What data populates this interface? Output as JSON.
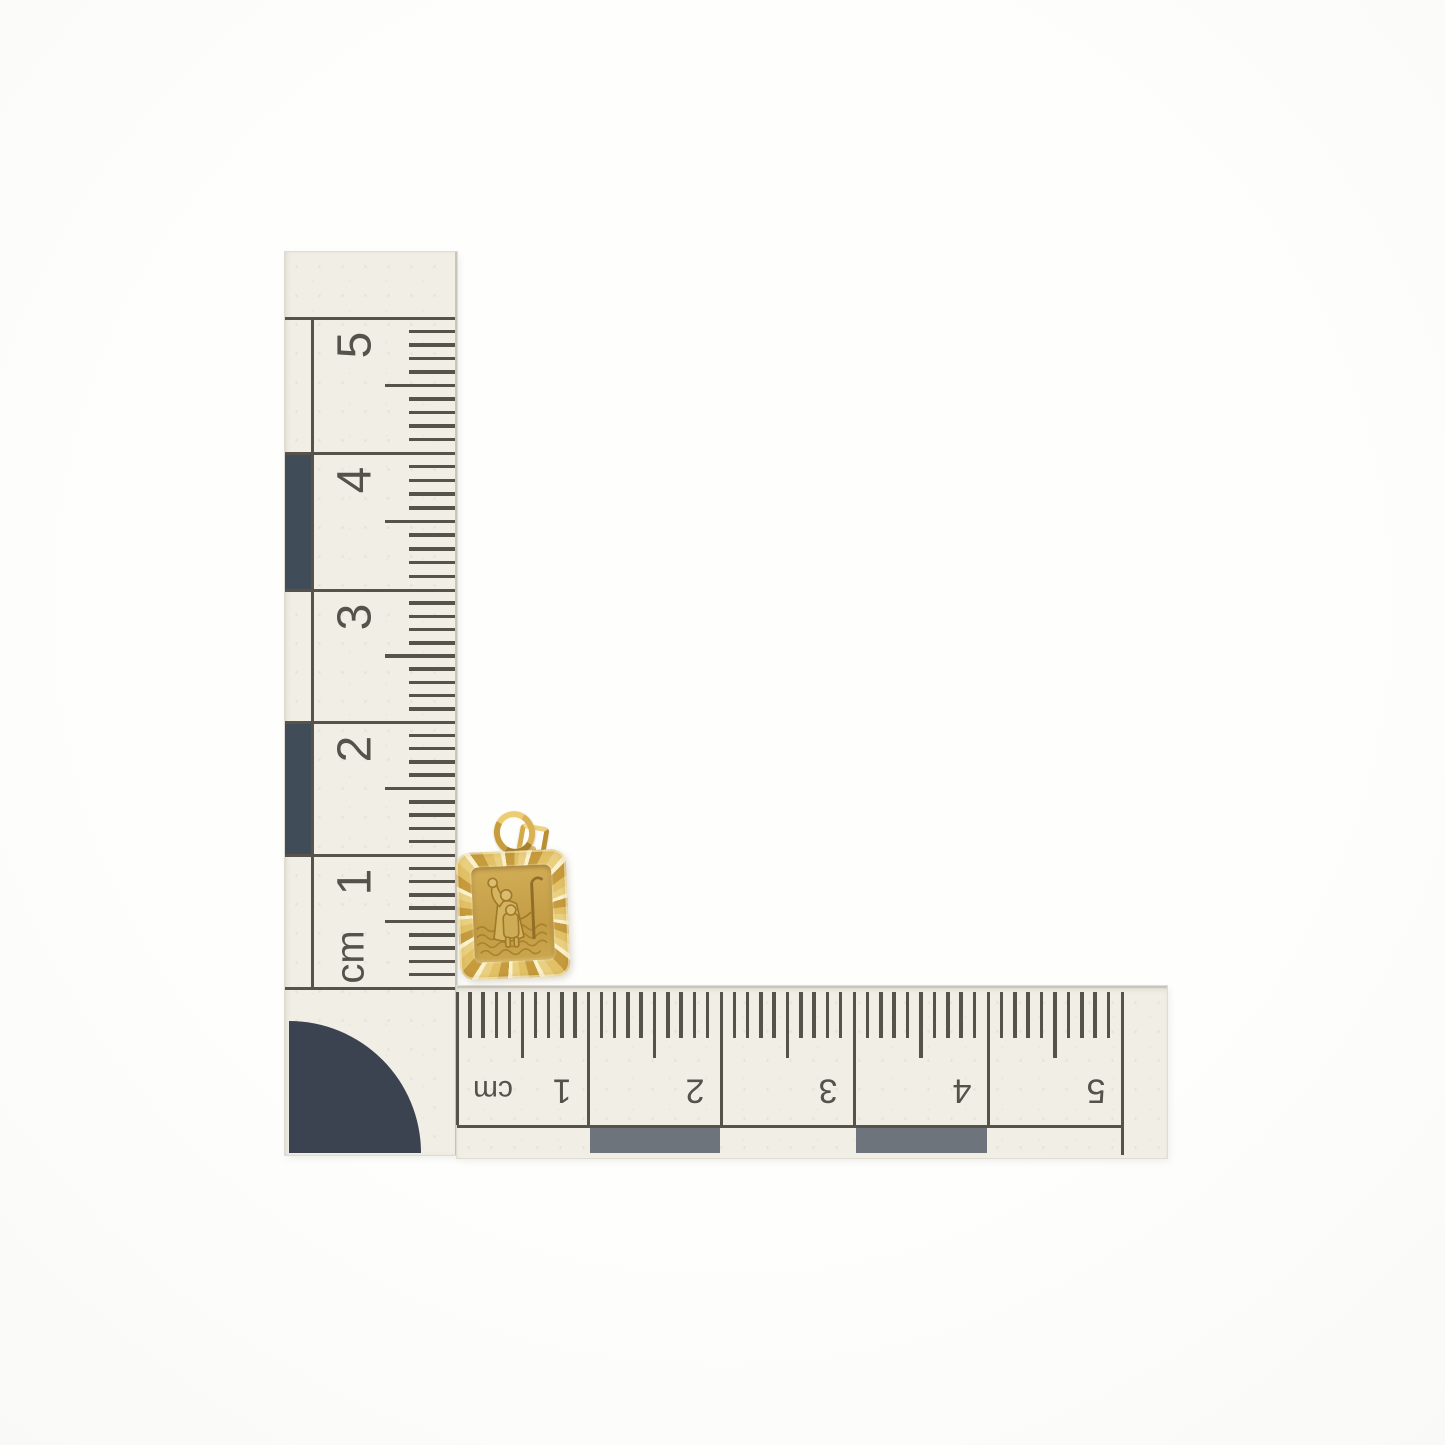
{
  "scene": {
    "background_color": "#fdfdfc",
    "subject": "gold rectangular St Christopher pendant photographed with two centimetre scale rulers"
  },
  "rulers": {
    "paper_color": "#f1eee6",
    "line_color": "#57534b",
    "digit_color": "#55514b",
    "vertical": {
      "unit_label": "cm",
      "labels": [
        "5",
        "4",
        "3",
        "2",
        "1",
        "cm"
      ],
      "dark_segment_color": "#414c59",
      "dark_segments_between_marks": [
        [
          "4",
          "3"
        ],
        [
          "2",
          "1"
        ]
      ],
      "corner_shape": "dark-quarter-circle",
      "corner_color": "#3c4350"
    },
    "horizontal": {
      "unit_label": "cm",
      "labels": [
        "cm",
        "1",
        "2",
        "3",
        "4",
        "5"
      ],
      "dark_segment_color": "#6e747b",
      "dark_segments_between_marks": [
        [
          "1",
          "2"
        ],
        [
          "3",
          "4"
        ]
      ],
      "text_orientation": "upside-down"
    }
  },
  "pendant": {
    "description": "rectangular gold tag pendant with diamond-cut faceted border, jump ring and bail, engraved with St Christopher carrying the Christ child across water",
    "gold_light": "#faf1cd",
    "gold_mid": "#d9b254",
    "gold_deep": "#b98c35",
    "panel_color": "#c8a44c",
    "engraving_color": "#9c7527"
  }
}
